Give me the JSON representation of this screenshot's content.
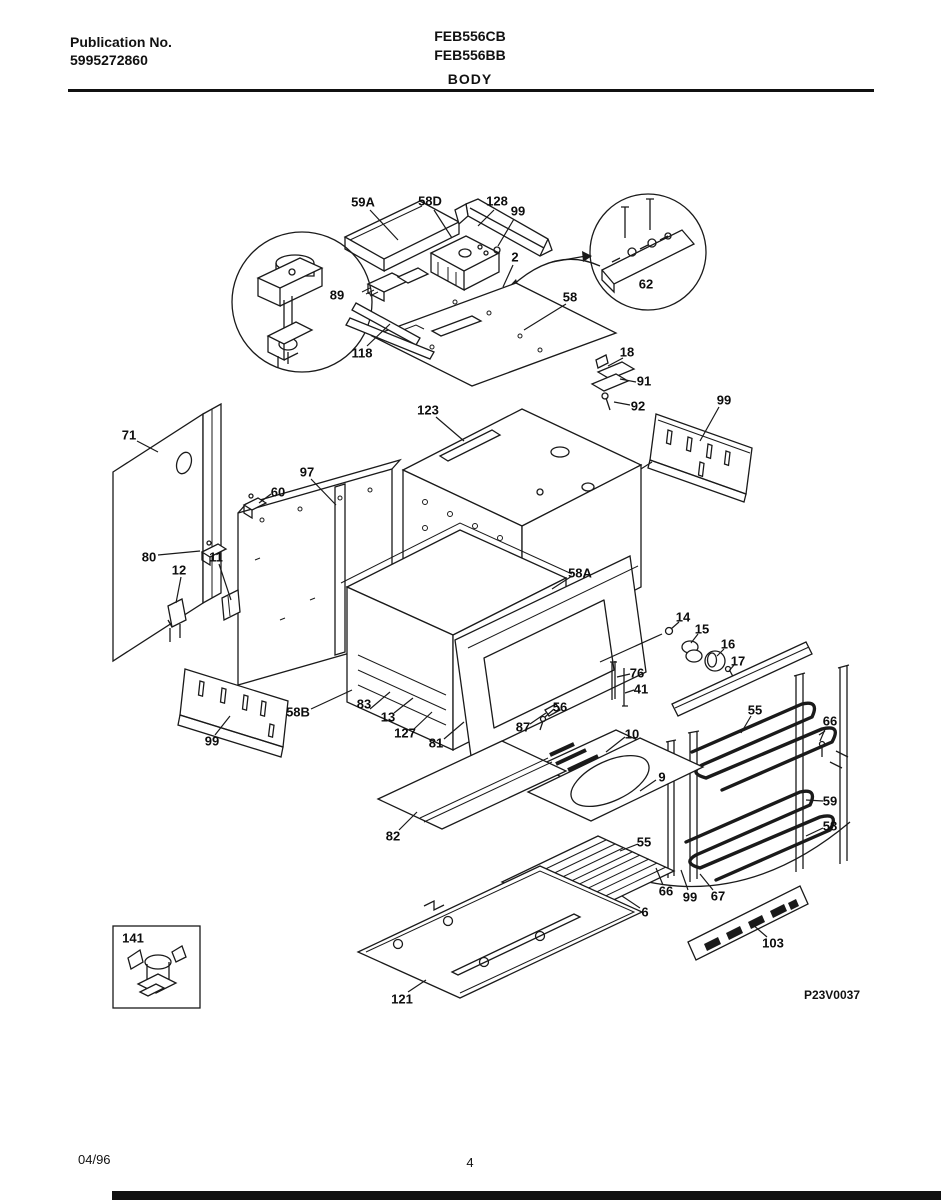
{
  "header": {
    "publication_label": "Publication No.",
    "publication_number": "5995272860",
    "model_1": "FEB556CB",
    "model_2": "FEB556BB",
    "section_title": "BODY"
  },
  "footer": {
    "date": "04/96",
    "page_number": "4"
  },
  "diagram": {
    "code": "P23V0037",
    "callouts": [
      {
        "text": "59A",
        "x": 363,
        "y": 202
      },
      {
        "text": "58D",
        "x": 430,
        "y": 201
      },
      {
        "text": "128",
        "x": 497,
        "y": 201
      },
      {
        "text": "99",
        "x": 518,
        "y": 211
      },
      {
        "text": "2",
        "x": 515,
        "y": 257
      },
      {
        "text": "89",
        "x": 337,
        "y": 295
      },
      {
        "text": "62",
        "x": 646,
        "y": 284
      },
      {
        "text": "58",
        "x": 570,
        "y": 297
      },
      {
        "text": "118",
        "x": 362,
        "y": 353
      },
      {
        "text": "18",
        "x": 627,
        "y": 352
      },
      {
        "text": "91",
        "x": 644,
        "y": 381
      },
      {
        "text": "92",
        "x": 638,
        "y": 406
      },
      {
        "text": "123",
        "x": 428,
        "y": 410
      },
      {
        "text": "99",
        "x": 724,
        "y": 400
      },
      {
        "text": "71",
        "x": 129,
        "y": 435
      },
      {
        "text": "97",
        "x": 307,
        "y": 472
      },
      {
        "text": "60",
        "x": 278,
        "y": 492
      },
      {
        "text": "80",
        "x": 149,
        "y": 557
      },
      {
        "text": "11",
        "x": 216,
        "y": 557
      },
      {
        "text": "12",
        "x": 179,
        "y": 570
      },
      {
        "text": "58A",
        "x": 580,
        "y": 573
      },
      {
        "text": "14",
        "x": 683,
        "y": 617
      },
      {
        "text": "15",
        "x": 702,
        "y": 629
      },
      {
        "text": "16",
        "x": 728,
        "y": 644
      },
      {
        "text": "17",
        "x": 738,
        "y": 661
      },
      {
        "text": "76",
        "x": 637,
        "y": 673
      },
      {
        "text": "41",
        "x": 641,
        "y": 689
      },
      {
        "text": "56",
        "x": 560,
        "y": 707
      },
      {
        "text": "87",
        "x": 523,
        "y": 727
      },
      {
        "text": "58B",
        "x": 298,
        "y": 712
      },
      {
        "text": "83",
        "x": 364,
        "y": 704
      },
      {
        "text": "13",
        "x": 388,
        "y": 717
      },
      {
        "text": "127",
        "x": 405,
        "y": 733
      },
      {
        "text": "81",
        "x": 436,
        "y": 743
      },
      {
        "text": "99",
        "x": 212,
        "y": 741
      },
      {
        "text": "10",
        "x": 632,
        "y": 734
      },
      {
        "text": "55",
        "x": 755,
        "y": 710
      },
      {
        "text": "66",
        "x": 830,
        "y": 721
      },
      {
        "text": "9",
        "x": 662,
        "y": 777
      },
      {
        "text": "59",
        "x": 830,
        "y": 801
      },
      {
        "text": "58",
        "x": 830,
        "y": 826
      },
      {
        "text": "82",
        "x": 393,
        "y": 836
      },
      {
        "text": "55",
        "x": 644,
        "y": 842
      },
      {
        "text": "66",
        "x": 666,
        "y": 891
      },
      {
        "text": "99",
        "x": 690,
        "y": 897
      },
      {
        "text": "67",
        "x": 718,
        "y": 896
      },
      {
        "text": "6",
        "x": 645,
        "y": 912
      },
      {
        "text": "103",
        "x": 773,
        "y": 943
      },
      {
        "text": "121",
        "x": 402,
        "y": 999
      },
      {
        "text": "141",
        "x": 133,
        "y": 938
      }
    ]
  }
}
